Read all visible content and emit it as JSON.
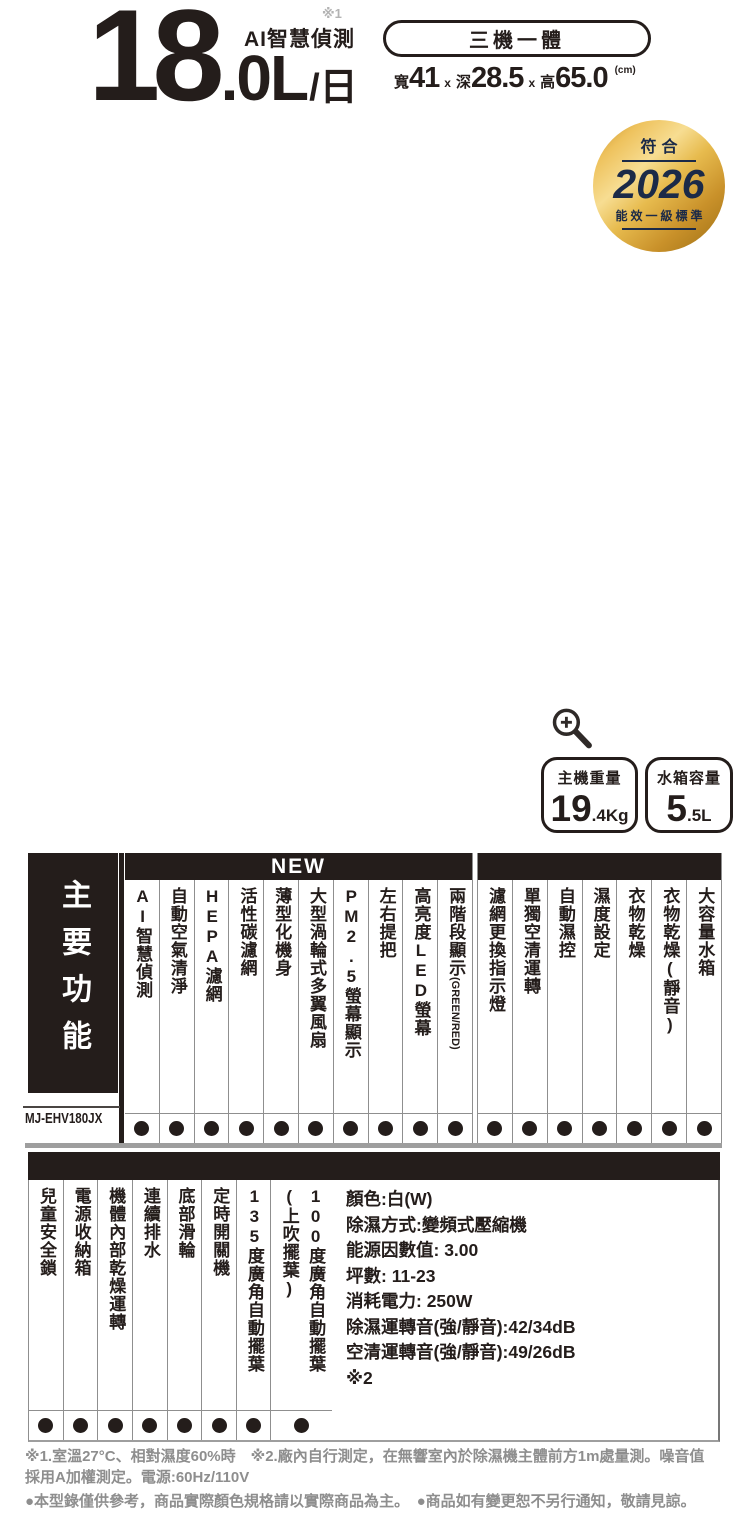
{
  "hero": {
    "capacity_int": "18",
    "capacity_suffix": ".0L",
    "per_day": "/日",
    "feature_label": "AI智慧偵測",
    "footnote_ref": "※1"
  },
  "pill": {
    "label": "三機一體"
  },
  "dimensions": {
    "segments": [
      {
        "label": "寬",
        "value": "41"
      },
      {
        "label": "深",
        "value": "28.5"
      },
      {
        "label": "高",
        "value": "65.0"
      }
    ],
    "separator": "x",
    "unit": "(cm)"
  },
  "badge": {
    "line1": "符合",
    "year": "2026",
    "line2": "能效一級標準"
  },
  "icons": {
    "zoom_icon": "magnifier-plus"
  },
  "stats": [
    {
      "label": "主機重量",
      "value": "19",
      "unit": ".4Kg"
    },
    {
      "label": "水箱容量",
      "value": "5",
      "unit": ".5L"
    }
  ],
  "features_table": {
    "sidebar_title": "主要功能",
    "model": "MJ-EHV180JX",
    "new_banner": "NEW",
    "new_columns": [
      {
        "label": "AI智慧偵測",
        "dot": true
      },
      {
        "label": "自動空氣清淨",
        "dot": true
      },
      {
        "label": "HEPA濾網",
        "dot": true
      },
      {
        "label": "活性碳濾網",
        "dot": true
      },
      {
        "label": "薄型化機身",
        "dot": true
      },
      {
        "label": "大型渦輪式多翼風扇",
        "dot": true
      },
      {
        "label": "PM2.5螢幕顯示",
        "dot": true
      },
      {
        "label": "左右提把",
        "dot": true
      },
      {
        "label": "高亮度LED螢幕",
        "dot": true
      },
      {
        "label": "兩階段顯示",
        "sideways_suffix": "(GREEN/RED)",
        "dot": true
      }
    ],
    "other_columns": [
      {
        "label": "濾網更換指示燈",
        "dot": true
      },
      {
        "label": "單獨空清運轉",
        "dot": true
      },
      {
        "label": "自動濕控",
        "dot": true
      },
      {
        "label": "濕度設定",
        "dot": true
      },
      {
        "label": "衣物乾燥",
        "dot": true
      },
      {
        "label": "衣物乾燥(靜音)",
        "dot": true
      },
      {
        "label": "大容量水箱",
        "dot": true
      }
    ]
  },
  "secondary_table": {
    "columns": [
      {
        "label": "兒童安全鎖",
        "dot": true
      },
      {
        "label": "電源收納箱",
        "dot": true
      },
      {
        "label": "機體內部乾燥運轉",
        "dot": true
      },
      {
        "label": "連續排水",
        "dot": true
      },
      {
        "label": "底部滑輪",
        "dot": true
      },
      {
        "label": "定時開關機",
        "dot": true
      },
      {
        "label": "135度廣角自動擺葉",
        "dot": true
      },
      {
        "label": "100度廣角自動擺葉",
        "label2": "(上吹擺葉)",
        "wide": true,
        "dot": true
      }
    ],
    "specs": [
      "顏色:白(W)",
      "除濕方式:變頻式壓縮機",
      "能源因數值: 3.00",
      "坪數: 11-23",
      "消耗電力: 250W",
      "除濕運轉音(強/靜音):42/34dB",
      "空清運轉音(強/靜音):49/26dB",
      "※2"
    ]
  },
  "footer": {
    "lines": [
      "※1.室溫27°C、相對濕度60%時　※2.廠內自行測定，在無響室內於除濕機主體前方1m處量測。噪音值",
      "採用A加權測定。電源:60Hz/110V",
      "●本型錄僅供參考，商品實際顏色規格請以實際商品為主。　●商品如有變更恕不另行通知，敬請見諒。"
    ]
  },
  "colors": {
    "ink": "#241d1b",
    "line_gray": "#9e9e9e",
    "note_gray": "#8e8e8e",
    "badge_gold": "#d9a033",
    "badge_navy": "#1b2a48"
  }
}
